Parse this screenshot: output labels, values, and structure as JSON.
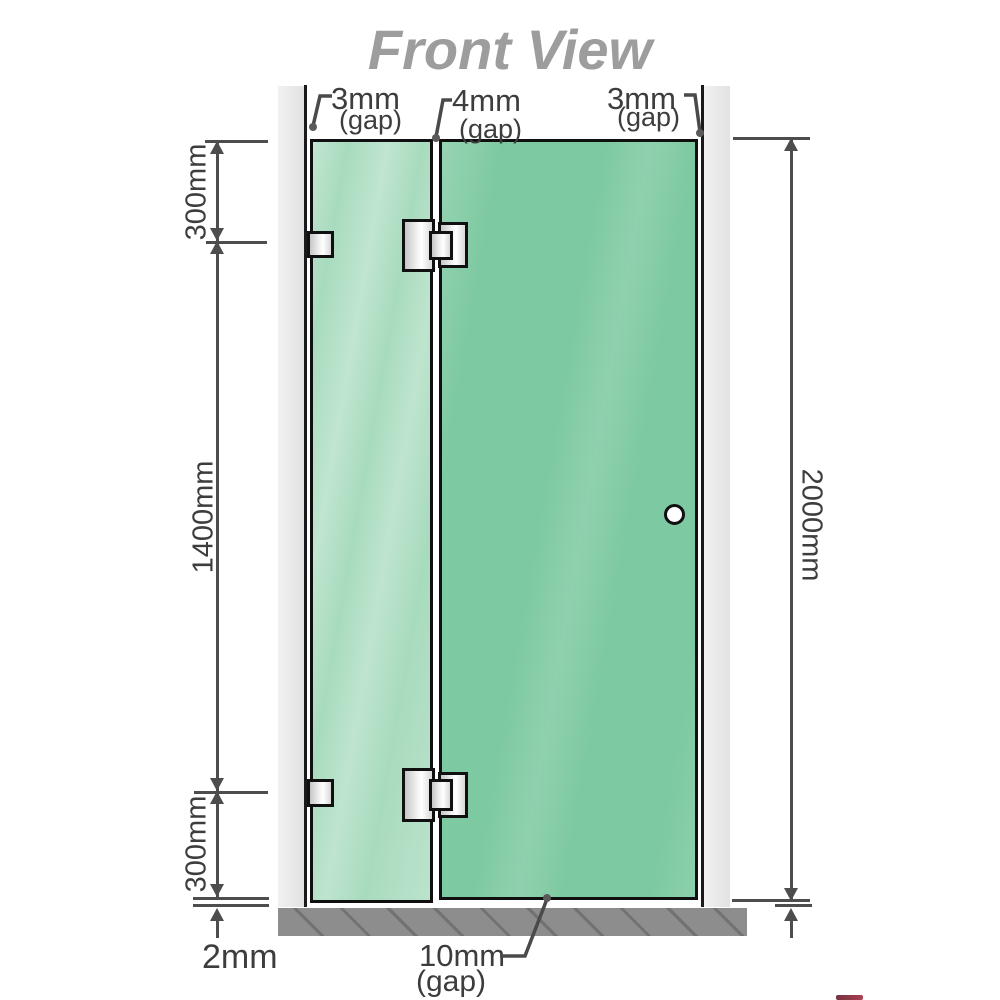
{
  "title": "Front View",
  "annotations": {
    "gap_top_left": {
      "value": "3mm",
      "qualifier": "(gap)"
    },
    "gap_top_middle": {
      "value": "4mm",
      "qualifier": "(gap)"
    },
    "gap_top_right": {
      "value": "3mm",
      "qualifier": "(gap)"
    },
    "gap_bottom": {
      "value": "10mm",
      "qualifier": "(gap)"
    },
    "segment_top": "300mm",
    "segment_middle": "1400mm",
    "segment_bottom": "300mm",
    "total_height": "2000mm",
    "floor_gap": "2mm"
  },
  "colors": {
    "glass_fixed_panel": "#a8dbbe",
    "glass_door_panel": "#7dc9a1",
    "wall_channel": "#e8e8e8",
    "floor_base": "#8d8d8d",
    "dimension_line": "#4d4d4d",
    "label_text": "#3d3d3d",
    "title_text": "#9d9d9d",
    "hardware_outline": "#101010"
  }
}
